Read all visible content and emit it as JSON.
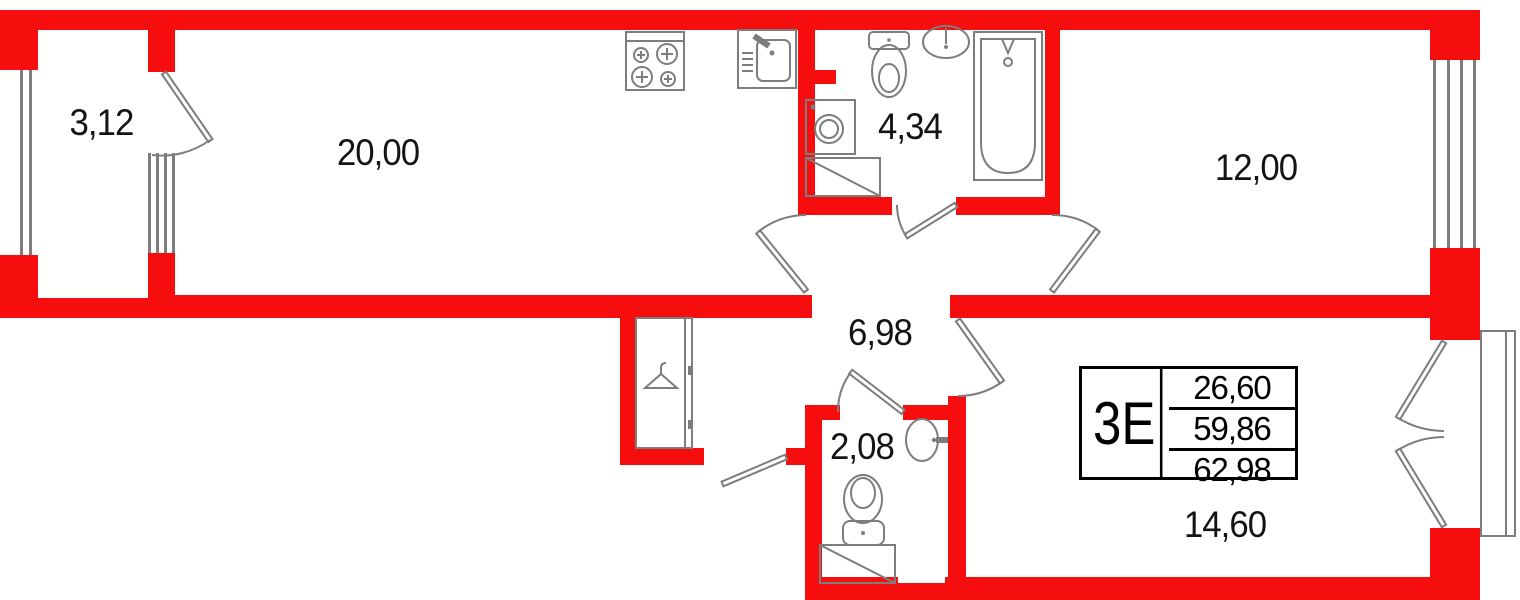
{
  "plan": {
    "unit": {
      "type_label": "3Е",
      "areas": [
        "26,60",
        "59,86",
        "62,98"
      ]
    },
    "rooms": {
      "balcony": "3,12",
      "kitchen_living": "20,00",
      "bathroom": "4,34",
      "bedroom1": "12,00",
      "hallway": "6,98",
      "wc": "2,08",
      "bedroom2": "14,60"
    },
    "colors": {
      "wall": "#f60d0d",
      "line": "#7d7d7d",
      "text": "#141414"
    },
    "icons": [
      "stove-icon",
      "kitchen-sink-icon",
      "toilet-icon",
      "washbasin-icon",
      "bathtub-icon",
      "washing-machine-icon",
      "appliance-space-icon",
      "wardrobe-icon",
      "hanger-icon",
      "window-icon",
      "door-swing-icon",
      "entry-door-icon",
      "balcony-outline-icon"
    ]
  }
}
